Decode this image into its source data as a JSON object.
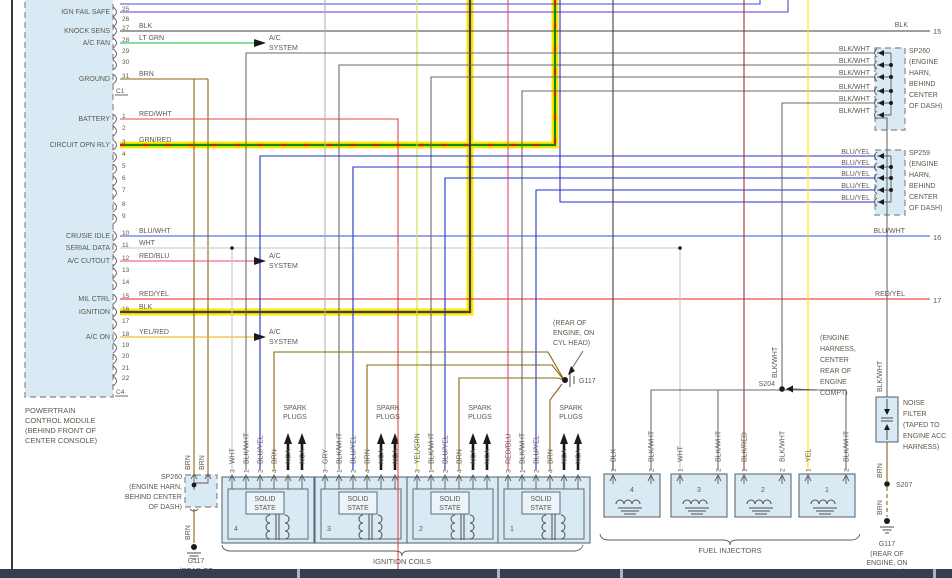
{
  "colors": {
    "highlight": "#ffe800",
    "box_fill": "#d9eaf4",
    "taskbar": "#333f4e",
    "blk": "#3f3f3f",
    "blk_wht": "#6b6b6b",
    "brn": "#8a6414",
    "blu_yel": "#2531cd",
    "blu_wht": "#3a4fd8",
    "lt_grn": "#00c23a",
    "grn_red": "#0f8a0f",
    "red_wht": "#e04848",
    "red_yel": "#ec1c1c",
    "red_blu": "#e8486e",
    "yel": "#ffe400",
    "yel_red": "#f0ae00",
    "wht": "#c6c6c6",
    "gry": "#b3b3b3",
    "yel_grn": "#d8d84a",
    "blk_red": "#9c3535"
  },
  "pcm": {
    "title_lines": [
      "POWERTRAIN",
      "CONTROL MODULE",
      "(BEHIND FRONT OF",
      "CENTER CONSOLE)"
    ],
    "connector_top": "C1",
    "connector_bottom": "C4",
    "pins": [
      {
        "num": "25",
        "name": "IGN FAIL SAFE"
      },
      {
        "num": "26"
      },
      {
        "num": "27",
        "name": "KNOCK SENS",
        "wire": "BLK"
      },
      {
        "num": "28",
        "name": "A/C FAN",
        "wire": "LT GRN"
      },
      {
        "num": "29"
      },
      {
        "num": "30"
      },
      {
        "num": "31",
        "name": "GROUND",
        "wire": "BRN"
      },
      {
        "num": "1",
        "name": "BATTERY",
        "wire": "RED/WHT"
      },
      {
        "num": "2"
      },
      {
        "num": "3",
        "name": "CIRCUIT OPN RLY",
        "wire": "GRN/RED"
      },
      {
        "num": "4"
      },
      {
        "num": "5"
      },
      {
        "num": "6"
      },
      {
        "num": "7"
      },
      {
        "num": "8"
      },
      {
        "num": "9"
      },
      {
        "num": "10",
        "name": "CRUSIE IDLE",
        "wire": "BLU/WHT"
      },
      {
        "num": "11",
        "name": "SERIAL DATA",
        "wire": "WHT"
      },
      {
        "num": "12",
        "name": "A/C CUTOUT",
        "wire": "RED/BLU"
      },
      {
        "num": "13"
      },
      {
        "num": "14"
      },
      {
        "num": "15",
        "name": "MIL CTRL",
        "wire": "RED/YEL"
      },
      {
        "num": "16",
        "name": "IGNITION",
        "wire": "BLK"
      },
      {
        "num": "17"
      },
      {
        "num": "18",
        "name": "A/C ON",
        "wire": "YEL/RED"
      },
      {
        "num": "19"
      },
      {
        "num": "20"
      },
      {
        "num": "21"
      },
      {
        "num": "22"
      }
    ]
  },
  "ac_system": {
    "line1": "A/C",
    "line2": "SYSTEM"
  },
  "right_refs": {
    "blk": "BLK",
    "r15": "15",
    "bluwht": "BLU/WHT",
    "r16": "16",
    "redyel": "RED/YEL",
    "r17": "17"
  },
  "sp260_top": {
    "name": "SP260",
    "wire": "BLK/WHT",
    "location_lines": [
      "(ENGINE",
      "HARN,",
      "BEHIND",
      "CENTER",
      "OF DASH)"
    ]
  },
  "sp259": {
    "name": "SP259",
    "wire": "BLU/YEL",
    "location_lines": [
      "(ENGINE",
      "HARN,",
      "BEHIND",
      "CENTER",
      "OF DASH)"
    ]
  },
  "sp260_bottom": {
    "name": "SP260",
    "wire": "BRN",
    "location_lines": [
      "(ENGINE HARN,",
      "BEHIND CENTER",
      "OF DASH)"
    ]
  },
  "g117_left": {
    "name": "G117",
    "location_lines": [
      "(REAR OF"
    ]
  },
  "g117_mid": {
    "name": "G117",
    "location_lines": [
      "(REAR OF",
      "ENGINE, ON",
      "CYL HEAD)"
    ]
  },
  "g117_right": {
    "name": "G117",
    "location_lines": [
      "(REAR OF",
      "ENGINE, ON",
      "CYL HEAD)"
    ]
  },
  "s204": {
    "name": "S204",
    "wire": "BLK/WHT",
    "location_lines": [
      "(ENGINE",
      "HARNESS,",
      "CENTER",
      "REAR OF",
      "ENGINE",
      "COMPT)"
    ]
  },
  "s207": {
    "name": "S207"
  },
  "noise_filter": {
    "label_lines": [
      "NOISE",
      "FILTER",
      "(TAPED TO",
      "ENGINE ACC",
      "HARNESS)"
    ]
  },
  "wire_names": {
    "brn": "BRN",
    "blkwht": "BLK/WHT"
  },
  "coils": {
    "caption": "IGNITION COILS",
    "solid_state": [
      "SOLID",
      "STATE"
    ],
    "spark_plugs": [
      "SPARK",
      "PLUGS"
    ],
    "nca": "NCA",
    "pin_numbers": [
      "3",
      "1",
      "2",
      "4"
    ],
    "items": [
      {
        "num": "4",
        "pin3_wire": "WHT",
        "pin1_wire": "BLK/WHT",
        "pin2_wire": "BLU/YEL",
        "pin4_wire": "BRN"
      },
      {
        "num": "3",
        "pin3_wire": "GRY",
        "pin1_wire": "BLK/WHT",
        "pin2_wire": "BLU/YEL",
        "pin4_wire": "BRN"
      },
      {
        "num": "2",
        "pin3_wire": "YEL/GRN",
        "pin1_wire": "BLK/WHT",
        "pin2_wire": "BLU/YEL",
        "pin4_wire": "BRN"
      },
      {
        "num": "1",
        "pin3_wire": "RED/BLU",
        "pin1_wire": "BLK/WHT",
        "pin2_wire": "BLU/YEL",
        "pin4_wire": "BRN"
      }
    ]
  },
  "injectors": {
    "caption": "FUEL INJECTORS",
    "pin_numbers": [
      "1",
      "2"
    ],
    "items": [
      {
        "num": "4",
        "pin1_wire": "BLK",
        "pin2_wire": "BLK/WHT"
      },
      {
        "num": "3",
        "pin1_wire": "WHT",
        "pin2_wire": "BLK/WHT"
      },
      {
        "num": "2",
        "pin1_wire": "BLK/RED",
        "pin2_wire": "BLK/WHT"
      },
      {
        "num": "1",
        "pin1_wire": "YEL",
        "pin2_wire": "BLK/WHT"
      }
    ]
  }
}
